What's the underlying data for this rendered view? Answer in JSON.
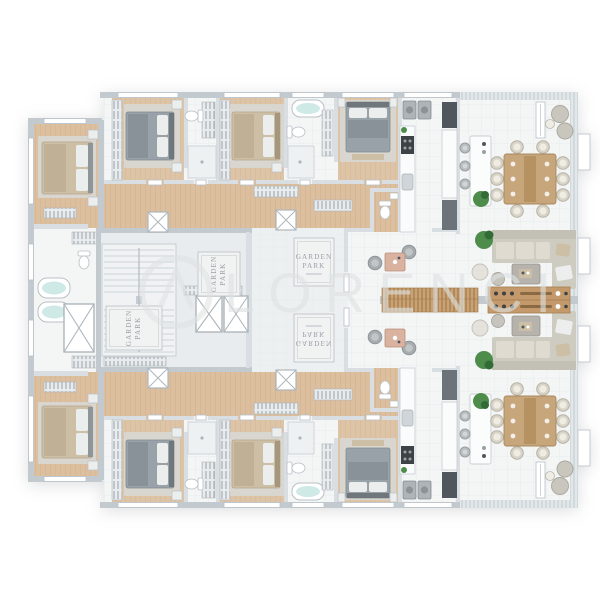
{
  "scene": {
    "type": "architectural-floor-plan-render",
    "description_visible_text_only": true
  },
  "watermark": {
    "text": "LORENCI"
  },
  "mat": {
    "line1": "GARDEN",
    "line2": "PARK"
  },
  "colors": {
    "bg": "#ffffff",
    "wall": "#c2cad0",
    "wallLight": "#d8dee2",
    "tile": "#f4f6f6",
    "tileDim": "#edf0f1",
    "coreFloor": "#e8ecee",
    "wood": "#dcbf9e",
    "woodDeep": "#d0a87e",
    "rug": "#d9d6cf",
    "bedGray": "#9aa2a9",
    "bedTan": "#cdbfa6",
    "linen": "#eceded",
    "sofa": "#cecbc1",
    "sofaLight": "#dfdbd0",
    "tableWood": "#c8a67c",
    "grillWood": "#c49a6d",
    "slatWood": "#caa273",
    "plant": "#4d8c4a",
    "plantDark": "#336b36",
    "water": "#cfe9e6",
    "dark": "#50575c",
    "chairShell": "#d8d3c7",
    "chairGray": "#a7acae",
    "stoolGray": "#b9bdbf",
    "matBg": "#f1f3f3",
    "matText": "#9aa1a7",
    "watermark": "#dee2e2",
    "windowLine": "#b8c0c5",
    "hatch": "#b9c1c6"
  }
}
